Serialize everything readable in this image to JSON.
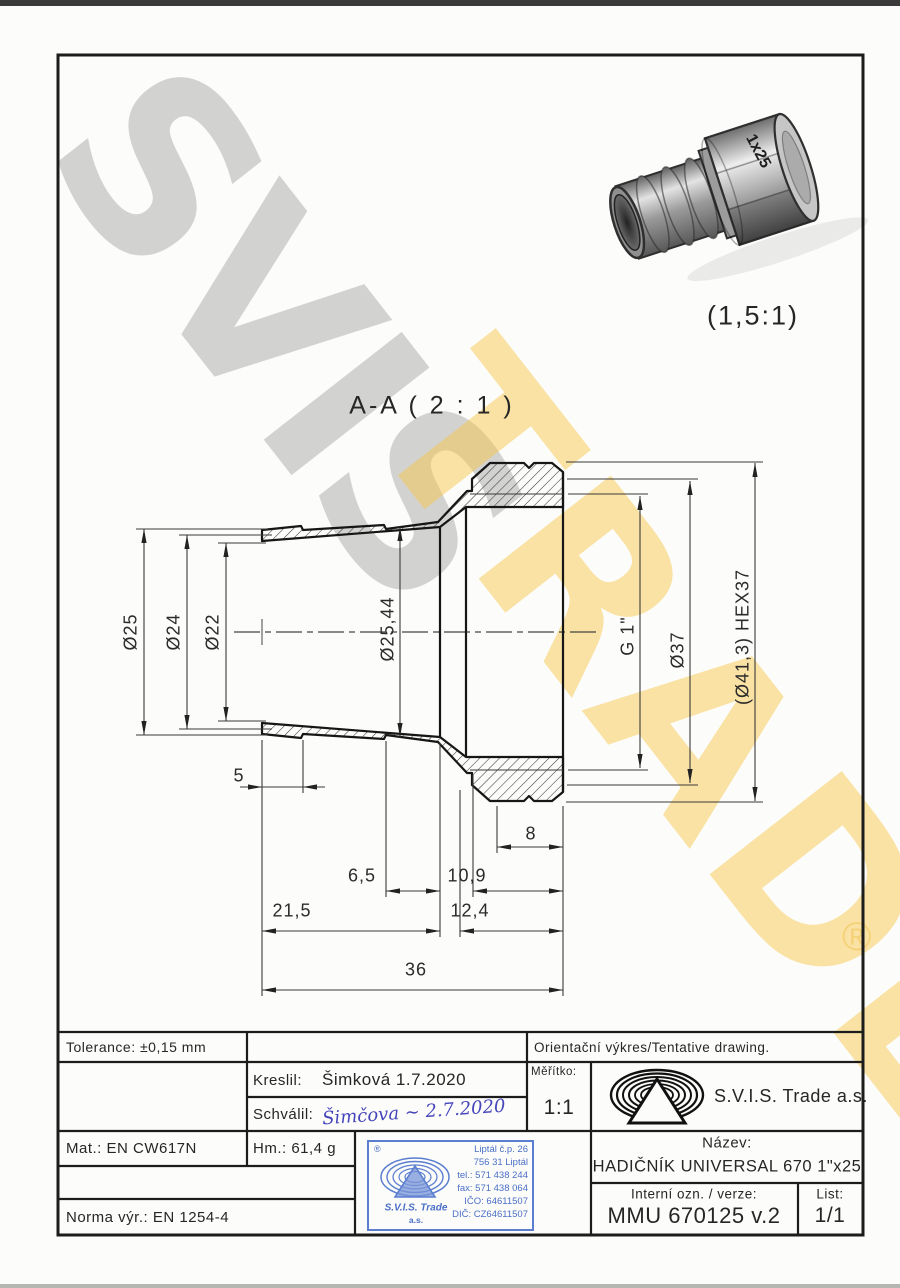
{
  "watermark": {
    "gray": "SVIS",
    "yellow": "TRADE",
    "registered": "®"
  },
  "render_3d": {
    "caption": "(1,5:1)",
    "nut_marking": "1x25"
  },
  "section": {
    "title": "A-A ( 2 : 1 )",
    "dims": {
      "d25": "Ø25",
      "d24": "Ø24",
      "d22": "Ø22",
      "d2544": "Ø25,44",
      "g1": "G 1\"",
      "d37": "Ø37",
      "hex": "(Ø41,3) HEX37",
      "len5": "5",
      "len8": "8",
      "len65": "6,5",
      "len109": "10,9",
      "len215": "21,5",
      "len124": "12,4",
      "len36": "36"
    }
  },
  "titleblock": {
    "tolerance": "Tolerance: ±0,15 mm",
    "orientacni": "Orientační výkres/Tentative drawing.",
    "kreslil_label": "Kreslil:",
    "kreslil_value": "Šimková 1.7.2020",
    "schvalil_label": "Schválil:",
    "schvalil_value": "Šimčova ~ 2.7.2020",
    "meritko_label": "Měřítko:",
    "meritko_value": "1:1",
    "company": "S.V.I.S. Trade a.s.",
    "mat": "Mat.: EN CW617N",
    "hm": "Hm.: 61,4 g",
    "norma": "Norma výr.: EN 1254-4",
    "nazev_label": "Název:",
    "nazev_value": "HADIČNÍK UNIVERSAL 670 1\"x25",
    "interni_label": "Interní ozn. / verze:",
    "interni_value": "MMU 670125 v.2",
    "list_label": "List:",
    "list_value": "1/1"
  },
  "stamp": {
    "registered": "®",
    "company": "S.V.I.S. Trade",
    "suffix": "a.s.",
    "line1": "Liptál č.p. 26",
    "line2": "756 31 Liptál",
    "line3": "tel.: 571 438 244",
    "line4": "fax: 571 438 064",
    "line5": "IČO: 64611507",
    "line6": "DIČ: CZ64611507"
  },
  "colors": {
    "line": "#1c1c1c",
    "stamp_blue": "#4a6fc7",
    "watermark_gray": "#a8a8a8",
    "watermark_yellow": "#f7c746"
  }
}
